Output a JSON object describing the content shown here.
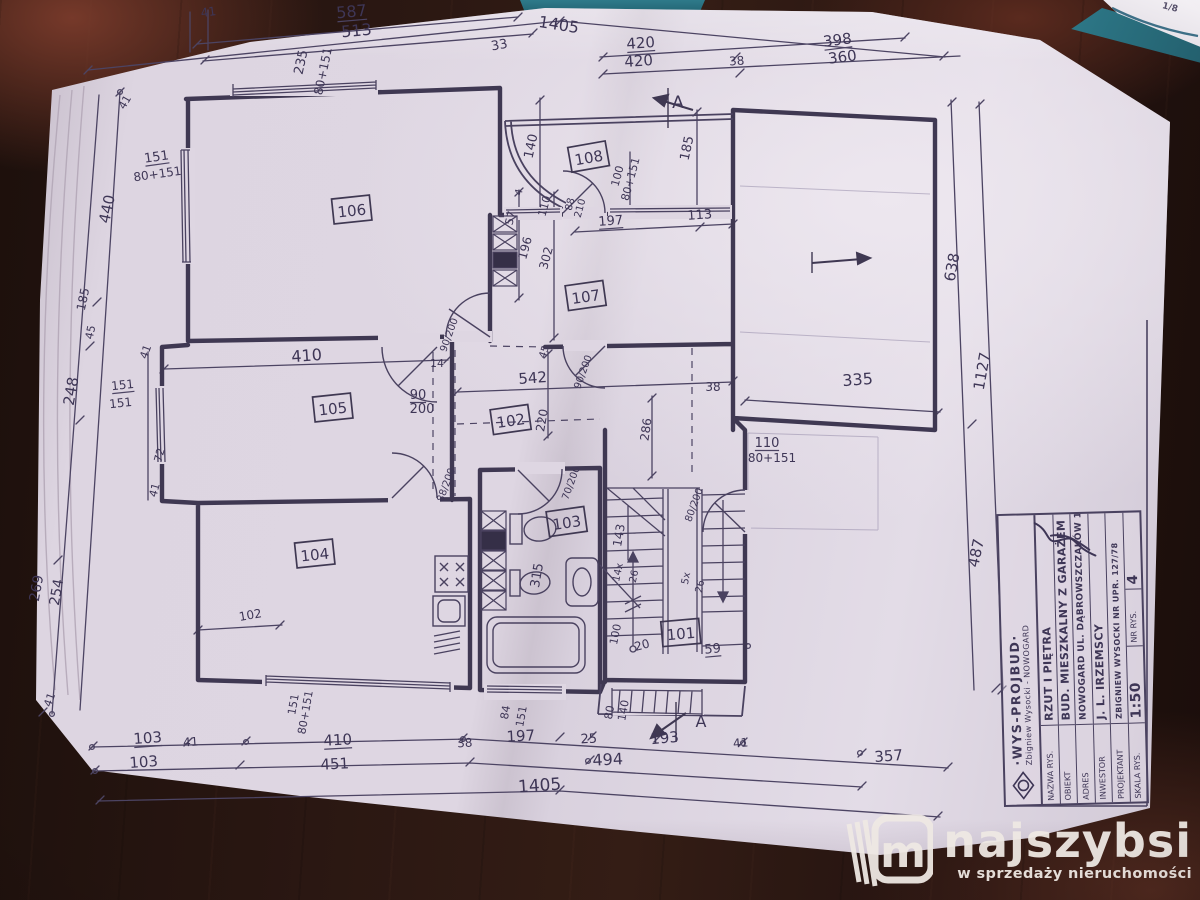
{
  "colors": {
    "ink": "#423a56",
    "paper": "#ded6e2",
    "wood": "#2a1712",
    "teal_folder": "#2e7a8a",
    "watermark": "#efe9e4"
  },
  "page_corner": {
    "label": "1/8"
  },
  "watermark": {
    "brand": "najszybsi",
    "tagline": "w sprzedaży nieruchomości",
    "logo_letter": "m"
  },
  "title_block": {
    "company": "·WYS-PROJBUD·",
    "company_sub": "Zbigniew Wysocki - NOWOGARD",
    "rows": [
      {
        "label": "NAZWA RYS.",
        "value": "RZUT I PIĘTRA"
      },
      {
        "label": "OBIEKT",
        "value": "BUD. MIESZKALNY Z GARAŻEM"
      },
      {
        "label": "ADRES",
        "value": "NOWOGARD UL. DĄBROWSZCZAKÓW 14"
      },
      {
        "label": "INWESTOR",
        "value": "J. L. IRZEMSCY"
      },
      {
        "label": "PROJEKTANT",
        "value": "Zbigniew Wysocki  nr upr. 127/78"
      },
      {
        "label": "SKALA RYS.",
        "value": "1:50"
      },
      {
        "label": "NR RYS.",
        "value": "4"
      }
    ]
  },
  "plan": {
    "rooms": [
      {
        "number": "106",
        "x": 352,
        "y": 212,
        "r": -6
      },
      {
        "number": "107",
        "x": 586,
        "y": 298,
        "r": -8
      },
      {
        "number": "108",
        "x": 589,
        "y": 159,
        "r": -10
      },
      {
        "number": "105",
        "x": 333,
        "y": 410,
        "r": -6
      },
      {
        "number": "102",
        "x": 511,
        "y": 422,
        "r": -8
      },
      {
        "number": "104",
        "x": 315,
        "y": 556,
        "r": -6
      },
      {
        "number": "103",
        "x": 567,
        "y": 524,
        "r": -8
      },
      {
        "number": "101",
        "x": 681,
        "y": 635,
        "r": -5
      }
    ],
    "labels": [
      [
        "41",
        209,
        16,
        -8,
        12,
        0
      ],
      [
        "587",
        352,
        17,
        -5,
        16,
        1
      ],
      [
        "513",
        357,
        36,
        -5,
        16,
        0
      ],
      [
        "235",
        305,
        63,
        -78,
        13,
        0
      ],
      [
        "80+151",
        327,
        72,
        -78,
        12,
        0
      ],
      [
        "33",
        500,
        49,
        -10,
        13,
        0
      ],
      [
        "1405",
        558,
        30,
        9,
        16,
        0
      ],
      [
        "420",
        641,
        48,
        -4,
        15,
        1
      ],
      [
        "420",
        639,
        66,
        -4,
        15,
        0
      ],
      [
        "38",
        737,
        65,
        -4,
        12,
        0
      ],
      [
        "398",
        838,
        45,
        -7,
        15,
        1
      ],
      [
        "360",
        843,
        62,
        -7,
        15,
        0
      ],
      [
        "A",
        678,
        108,
        0,
        17,
        0
      ],
      [
        "638",
        957,
        268,
        -80,
        15,
        0
      ],
      [
        "1127",
        987,
        372,
        -80,
        15,
        0
      ],
      [
        "38",
        713,
        391,
        0,
        12,
        0
      ],
      [
        "335",
        858,
        385,
        -4,
        16,
        0
      ],
      [
        "110",
        767,
        447,
        0,
        13,
        1
      ],
      [
        "80+151",
        772,
        462,
        0,
        12,
        0
      ],
      [
        "487",
        981,
        554,
        -78,
        15,
        0
      ],
      [
        "41",
        128,
        104,
        -60,
        11,
        0
      ],
      [
        "151",
        157,
        161,
        -8,
        13,
        1
      ],
      [
        "80+151",
        158,
        178,
        -8,
        12,
        0
      ],
      [
        "440",
        112,
        210,
        -78,
        15,
        0
      ],
      [
        "185",
        87,
        300,
        -78,
        12,
        0
      ],
      [
        "45",
        94,
        333,
        -78,
        11,
        0
      ],
      [
        "248",
        76,
        392,
        -80,
        15,
        0
      ],
      [
        "151",
        123,
        389,
        -6,
        12,
        1
      ],
      [
        "151",
        121,
        407,
        -6,
        12,
        0
      ],
      [
        "41",
        149,
        353,
        -70,
        11,
        0
      ],
      [
        "72",
        163,
        456,
        -75,
        11,
        0
      ],
      [
        "41",
        158,
        491,
        -75,
        11,
        0
      ],
      [
        "269",
        41,
        589,
        -80,
        14,
        0
      ],
      [
        "254",
        61,
        593,
        -80,
        14,
        0
      ],
      [
        "41",
        53,
        701,
        -70,
        11,
        0
      ],
      [
        "140",
        535,
        147,
        -78,
        13,
        0
      ],
      [
        "185",
        691,
        149,
        -78,
        13,
        0
      ],
      [
        "100",
        621,
        177,
        -75,
        11,
        0
      ],
      [
        "80+151",
        634,
        180,
        -75,
        11,
        0
      ],
      [
        "88",
        573,
        205,
        -75,
        10,
        0
      ],
      [
        "210",
        583,
        209,
        -75,
        10,
        0
      ],
      [
        "197",
        611,
        225,
        -4,
        13,
        1
      ],
      [
        "113",
        700,
        219,
        -4,
        13,
        0
      ],
      [
        "4",
        522,
        193,
        -75,
        10,
        0
      ],
      [
        "57",
        514,
        219,
        -75,
        11,
        0
      ],
      [
        "110",
        548,
        207,
        -75,
        11,
        0
      ],
      [
        "196",
        529,
        249,
        -75,
        12,
        0
      ],
      [
        "302",
        550,
        259,
        -75,
        12,
        0
      ],
      [
        "90/200",
        452,
        336,
        -70,
        10,
        0
      ],
      [
        "45",
        547,
        353,
        -70,
        10,
        0
      ],
      [
        "90/200",
        586,
        373,
        -70,
        10,
        0
      ],
      [
        "410",
        307,
        361,
        -4,
        16,
        0
      ],
      [
        "14",
        437,
        367,
        0,
        11,
        0
      ],
      [
        "542",
        533,
        383,
        -4,
        15,
        0
      ],
      [
        "90",
        418,
        399,
        0,
        13,
        1
      ],
      [
        "200",
        422,
        413,
        0,
        13,
        0
      ],
      [
        "220",
        546,
        421,
        -80,
        12,
        0
      ],
      [
        "286",
        650,
        430,
        -82,
        12,
        0
      ],
      [
        "88/200",
        449,
        486,
        -70,
        10,
        0
      ],
      [
        "70/200",
        574,
        484,
        -70,
        10,
        0
      ],
      [
        "80/200",
        697,
        506,
        -70,
        10,
        0
      ],
      [
        "315",
        541,
        576,
        -80,
        13,
        0
      ],
      [
        "143",
        623,
        536,
        -80,
        12,
        0
      ],
      [
        "14x",
        621,
        573,
        -78,
        10,
        0
      ],
      [
        "26",
        637,
        577,
        -78,
        10,
        0
      ],
      [
        "5x",
        689,
        579,
        -78,
        10,
        0
      ],
      [
        "26",
        703,
        587,
        -78,
        10,
        0
      ],
      [
        "100",
        619,
        635,
        -78,
        11,
        0
      ],
      [
        "20",
        643,
        649,
        -15,
        12,
        0
      ],
      [
        "59",
        713,
        653,
        -5,
        13,
        1
      ],
      [
        "102",
        251,
        619,
        -10,
        12,
        0
      ],
      [
        "103",
        148,
        743,
        -4,
        15,
        1
      ],
      [
        "103",
        144,
        767,
        -4,
        15,
        0
      ],
      [
        "41",
        191,
        746,
        -4,
        12,
        0
      ],
      [
        "151",
        297,
        705,
        -80,
        11,
        0
      ],
      [
        "80+151",
        309,
        713,
        -80,
        11,
        0
      ],
      [
        "410",
        338,
        745,
        -3,
        15,
        1
      ],
      [
        "451",
        335,
        769,
        -3,
        15,
        0
      ],
      [
        "38",
        465,
        747,
        -3,
        12,
        0
      ],
      [
        "84",
        509,
        713,
        -80,
        11,
        0
      ],
      [
        "151",
        525,
        717,
        -80,
        11,
        0
      ],
      [
        "197",
        521,
        741,
        -3,
        15,
        0
      ],
      [
        "25",
        589,
        743,
        -3,
        13,
        0
      ],
      [
        "494",
        608,
        765,
        -3,
        16,
        0
      ],
      [
        "80",
        613,
        713,
        -80,
        11,
        0
      ],
      [
        "140",
        627,
        711,
        -80,
        11,
        0
      ],
      [
        "193",
        665,
        743,
        -5,
        15,
        0
      ],
      [
        "A",
        701,
        727,
        0,
        16,
        0
      ],
      [
        "41",
        741,
        747,
        -5,
        12,
        0
      ],
      [
        "1405",
        540,
        791,
        -4,
        17,
        0
      ],
      [
        "357",
        889,
        761,
        -4,
        15,
        0
      ]
    ]
  }
}
